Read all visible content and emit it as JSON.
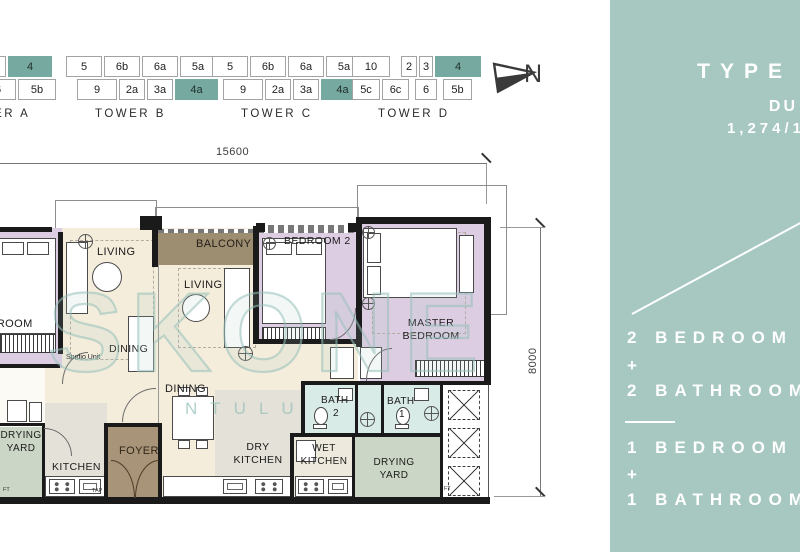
{
  "colors": {
    "sidebar_bg": "#a6c8c1",
    "unit_highlight": "#76a99f",
    "bedroom_fill": "#ddcde2",
    "living_fill": "#f4eddb",
    "balcony_fill": "#9d8d71",
    "foyer_fill": "#a89478",
    "kitchen_fill": "#e4e1d9",
    "bath_fill": "#d9ebe7",
    "yard_fill": "#ccd6c6",
    "wall": "#1a1a1a"
  },
  "towers": {
    "a": {
      "name": "TOWER A",
      "row1": [
        {
          "t": "4",
          "hl": true
        }
      ],
      "row2": [
        {
          "t": "6"
        },
        {
          "t": "5b"
        }
      ]
    },
    "b": {
      "name": "TOWER B",
      "row1": [
        {
          "t": "5"
        },
        {
          "t": "6b"
        },
        {
          "t": "6a"
        },
        {
          "t": "5a"
        }
      ],
      "row2": [
        {
          "t": "9"
        },
        {
          "t": "2a"
        },
        {
          "t": "3a"
        },
        {
          "t": "4a",
          "hl": true
        }
      ]
    },
    "c": {
      "name": "TOWER C",
      "row1": [
        {
          "t": "5"
        },
        {
          "t": "6b"
        },
        {
          "t": "6a"
        },
        {
          "t": "5a"
        }
      ],
      "row2": [
        {
          "t": "9"
        },
        {
          "t": "2a"
        },
        {
          "t": "3a"
        },
        {
          "t": "4a",
          "hl": true
        }
      ]
    },
    "d": {
      "name": "TOWER D",
      "row1": [
        {
          "t": "10"
        },
        {
          "t": "2"
        },
        {
          "t": "3"
        },
        {
          "t": "4",
          "hl": true
        }
      ],
      "row2": [
        {
          "t": "5c"
        },
        {
          "t": "6c"
        },
        {
          "t": "6"
        },
        {
          "t": "5b"
        }
      ]
    }
  },
  "north": "N",
  "dimensions": {
    "width": "15600",
    "height": "8000"
  },
  "watermark": {
    "main": "SKONE",
    "sub": "NTULU"
  },
  "plan": {
    "studio": {
      "bedroom": "BEDROOM",
      "living": "LIVING",
      "dining": "DINING",
      "unit_note": "Studio Unit",
      "kitchen": "KITCHEN",
      "drying_line1": "DRYING",
      "drying_line2": "YARD"
    },
    "main": {
      "balcony": "BALCONY",
      "living": "LIVING",
      "dining": "DINING",
      "bedroom2": "BEDROOM 2",
      "master_line1": "MASTER",
      "master_line2": "BEDROOM",
      "foyer": "FOYER",
      "dry_kitchen_line1": "DRY",
      "dry_kitchen_line2": "KITCHEN",
      "wet_kitchen_line1": "WET",
      "wet_kitchen_line2": "KITCHEN",
      "bath2": "BATH",
      "bath2_num": "2",
      "bath1": "BATH",
      "bath1_num": "1",
      "drying_line1": "DRYING",
      "drying_line2": "YARD"
    },
    "annotations": {
      "ft": "FT",
      "tap": "TAP"
    }
  },
  "sidebar": {
    "title": "TYPE",
    "subtitle": "DU",
    "area": "1,274/1",
    "unit1_beds": "2 BEDROOM",
    "plus1": "+",
    "unit1_baths": "2 BATHROOM",
    "unit2_beds": "1 BEDROOM",
    "plus2": "+",
    "unit2_baths": "1 BATHROOM"
  }
}
